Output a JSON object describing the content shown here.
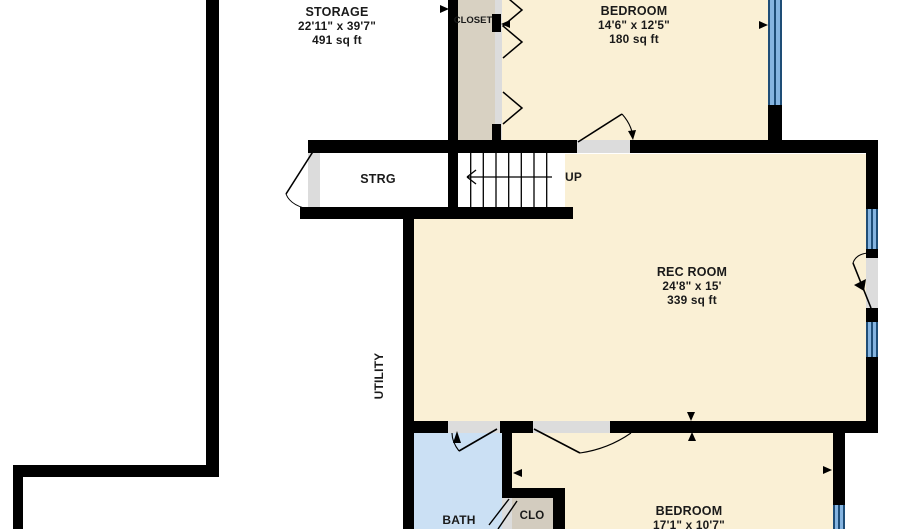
{
  "plan": {
    "title": "basement floor plan",
    "rooms": {
      "storage": {
        "name": "STORAGE",
        "dims": "22'11\" x 39'7\"",
        "area": "491 sq ft"
      },
      "closet": {
        "name": "CLOSET"
      },
      "bedroom_upper": {
        "name": "BEDROOM",
        "dims": "14'6\" x 12'5\"",
        "area": "180 sq ft"
      },
      "strg": {
        "name": "STRG"
      },
      "stairs": {
        "direction_label": "UP"
      },
      "rec_room": {
        "name": "REC ROOM",
        "dims": "24'8\" x 15'",
        "area": "339 sq ft"
      },
      "utility": {
        "name": "UTILITY"
      },
      "bath": {
        "name": "BATH"
      },
      "clo": {
        "name": "CLO"
      },
      "bedroom_lower": {
        "name": "BEDROOM",
        "dims": "17'1\" x 10'7\""
      }
    },
    "colors": {
      "room_fill": "#FAF0D5",
      "closet_fill": "#D8D1C2",
      "bath_fill": "#CBE0F4",
      "clo_fill": "#D3CCBF",
      "wall": "#000000",
      "window_fill": "#85B4E0",
      "window_frame": "#1E4D77",
      "door_opening": "#DCDCDC"
    }
  }
}
